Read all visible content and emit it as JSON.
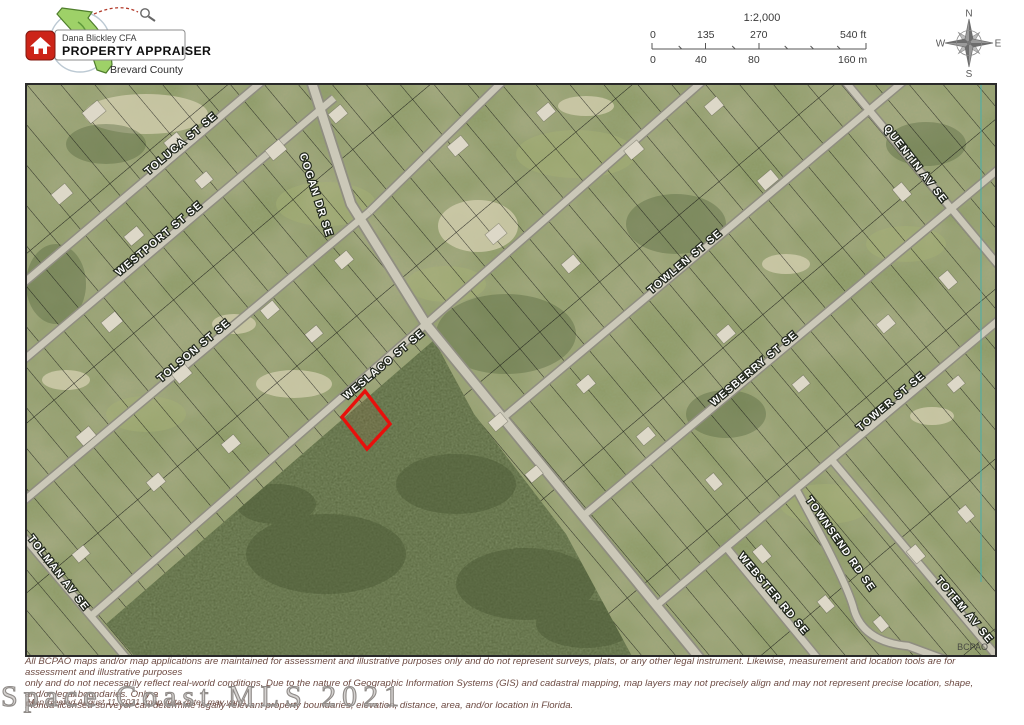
{
  "header": {
    "logo": {
      "name": "Dana Blickley CFA",
      "title": "PROPERTY APPRAISER",
      "county": "Brevard County"
    },
    "scale": {
      "ratio": "1:2,000",
      "feet": [
        "0",
        "135",
        "270",
        "540 ft"
      ],
      "meters": [
        "0",
        "40",
        "80",
        "160 m"
      ]
    },
    "compass": {
      "north": "N",
      "south": "S",
      "east": "E",
      "west": "W"
    }
  },
  "map": {
    "streets": [
      {
        "name": "TOLUCA ST SE"
      },
      {
        "name": "WESTPORT ST SE"
      },
      {
        "name": "TOLSON ST SE"
      },
      {
        "name": "WESLACO ST SE"
      },
      {
        "name": "TOLMAN AV SE"
      },
      {
        "name": "COGAN DR SE"
      },
      {
        "name": "TOWLEN ST SE"
      },
      {
        "name": "WESBERRY ST SE"
      },
      {
        "name": "TOWER ST SE"
      },
      {
        "name": "QUENTIN AV SE"
      },
      {
        "name": "TOWNSEND RD SE"
      },
      {
        "name": "WEBSTER RD SE"
      },
      {
        "name": "TOTEM AV SE"
      }
    ],
    "bcpao": "BCPAO",
    "highlight_color": "#e8100c"
  },
  "watermark": "Space Coast MLS 2021",
  "footer": {
    "disclaimer_lines": [
      "All BCPAO maps and/or map applications are maintained for assessment and illustrative purposes only and do not represent surveys, plats, or any other legal instrument. Likewise, measurement and location tools are for assessment and illustrative purposes",
      "only and do not necessarily reflect real-world conditions. Due to the nature of Geographic Information Systems (GIS) and cadastral mapping, map layers may not precisely align and may not represent precise location, shape, and/or legal boundaries. Only a",
      "Florida-licensed surveyor can determine legally-relevant property boundaries, elevation, distance, area, and/or location in Florida."
    ],
    "created": "Map created August 11, 2021 (map data dates may vary)"
  }
}
